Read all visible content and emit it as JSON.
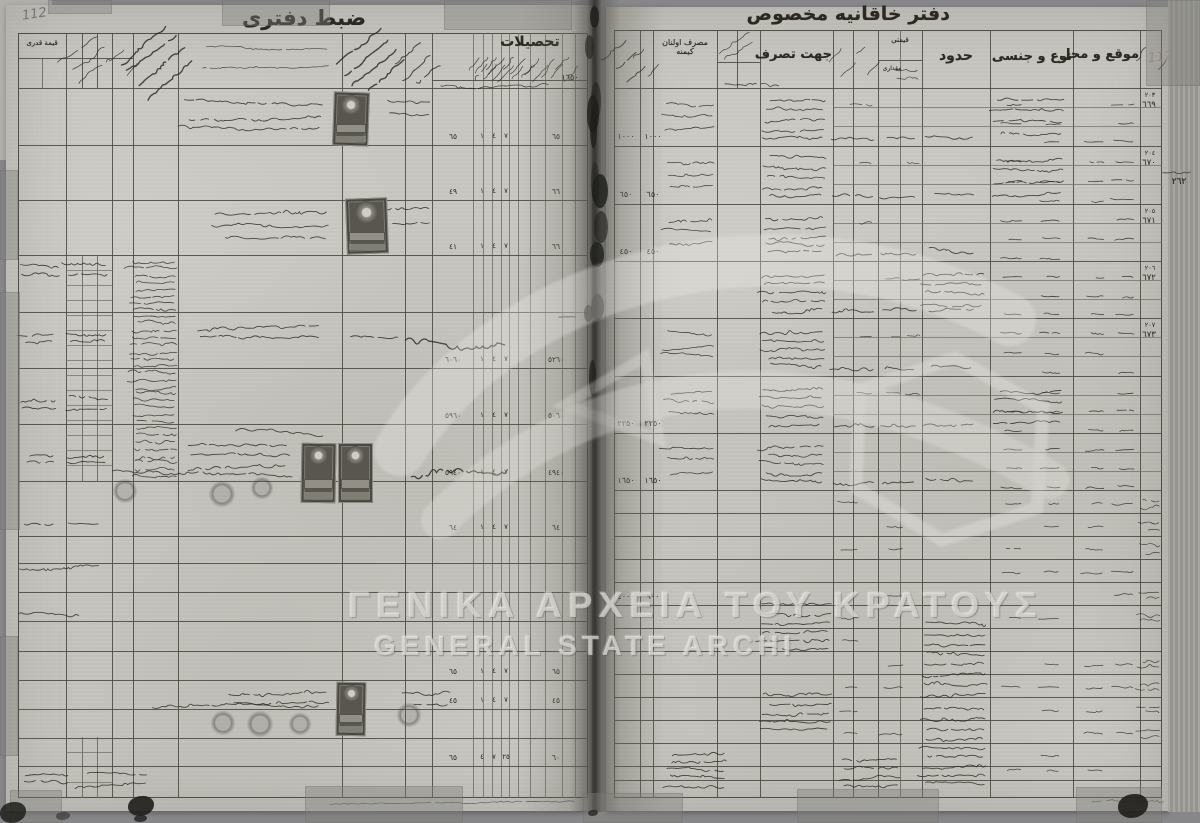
{
  "scan": {
    "watermark": {
      "greek": "ΓΕΝΙΚΑ ΑΡΧΕΙΑ ΤΟΥ ΚΡΑΤΟΥΣ",
      "latin": "GENERAL STATE ARCHI"
    },
    "colors": {
      "paper": "#c8c7c1",
      "ink": "#2b2921",
      "grid_line": "#4f4d44",
      "pencil": "#73737a",
      "red_pencil": "#a28f8c",
      "stamp_dark": "#58564f"
    }
  },
  "left_page": {
    "pencil_number": "112",
    "title": "ضبط دفترى",
    "headers": {
      "kiymet_kadr": "قيمة قدرى",
      "tahsilat": "تحصيلات",
      "tahsilat_total": "١٦٥٠"
    },
    "row_figures": [
      {
        "row": 1,
        "cells": [
          "٦٥",
          "١",
          "٤",
          "٧",
          "٦٥"
        ]
      },
      {
        "row": 2,
        "cells": [
          "٤٩",
          "١",
          "٤",
          "٧",
          "٦٦"
        ]
      },
      {
        "row": 3,
        "cells": [
          "٤١",
          "١",
          "٤",
          "٧",
          "٦٦"
        ]
      },
      {
        "row": 5,
        "cells": [
          "٦٠٦٠",
          "١",
          "٤",
          "٧",
          "٥٢٦٠"
        ]
      },
      {
        "row": 6,
        "cells": [
          "٥٩٦٠",
          "١",
          "٤",
          "٧",
          "٥٠٦٠"
        ]
      },
      {
        "row": 7,
        "cells": [
          "٥٩٤٠",
          "١",
          "٤",
          "٧",
          "٤٩٤٠"
        ]
      },
      {
        "row": 8,
        "cells": [
          "٦٤",
          "١",
          "٤",
          "٧",
          "٦٤"
        ]
      },
      {
        "row": 13,
        "cells": [
          "٦٥",
          "١",
          "٤",
          "٧",
          "٦٥"
        ]
      },
      {
        "row": 14,
        "cells": [
          "٤٥",
          "١",
          "٤",
          "٧",
          "٤٥"
        ]
      },
      {
        "row": 16,
        "cells": [
          "٦٥",
          "٤",
          "٧",
          "٢٥",
          "٦٠"
        ]
      }
    ]
  },
  "right_page": {
    "pencil_number": "112",
    "title": "دفتر خاقانيه مخصوص",
    "headers": {
      "masraf": "مصرف اولنان كيمنه",
      "cihet": "جهت تصرف",
      "kiymet": "قيمتى",
      "mikdar": "مقدارى",
      "hudud": "حدود",
      "nev": "نوع و جنسى",
      "mevki": "موقع و محل"
    },
    "amount_pairs": [
      {
        "group": 0,
        "a": "١٠٠٠",
        "b": "١٠٠٠"
      },
      {
        "group": 1,
        "a": "٦٥٠",
        "b": "٦٥٠"
      },
      {
        "group": 2,
        "a": "٤٥٠",
        "b": "٤٥٠"
      },
      {
        "group": 5,
        "a": "٢٢٥٠",
        "b": "٢٢٥٠"
      },
      {
        "group": 6,
        "a": "١٦٥٠",
        "b": "١٦٥٠"
      }
    ],
    "lower_amounts": [
      {
        "thin_row": 4,
        "a": "٤٠٠٠",
        "b": "٩٠٠"
      }
    ],
    "serials": [
      {
        "group": 0,
        "small": "٢٠٣",
        "big": "٦٦٩"
      },
      {
        "group": 1,
        "small": "٢٠٤",
        "big": "٦٧٠"
      },
      {
        "group": 2,
        "small": "٢٠٥",
        "big": "٦٧١"
      },
      {
        "group": 3,
        "small": "٢٠٦",
        "big": "٦٧٢"
      },
      {
        "group": 4,
        "small": "٢٠٧",
        "big": "٦٧٣"
      }
    ],
    "margin_note": "٢٦٢"
  }
}
